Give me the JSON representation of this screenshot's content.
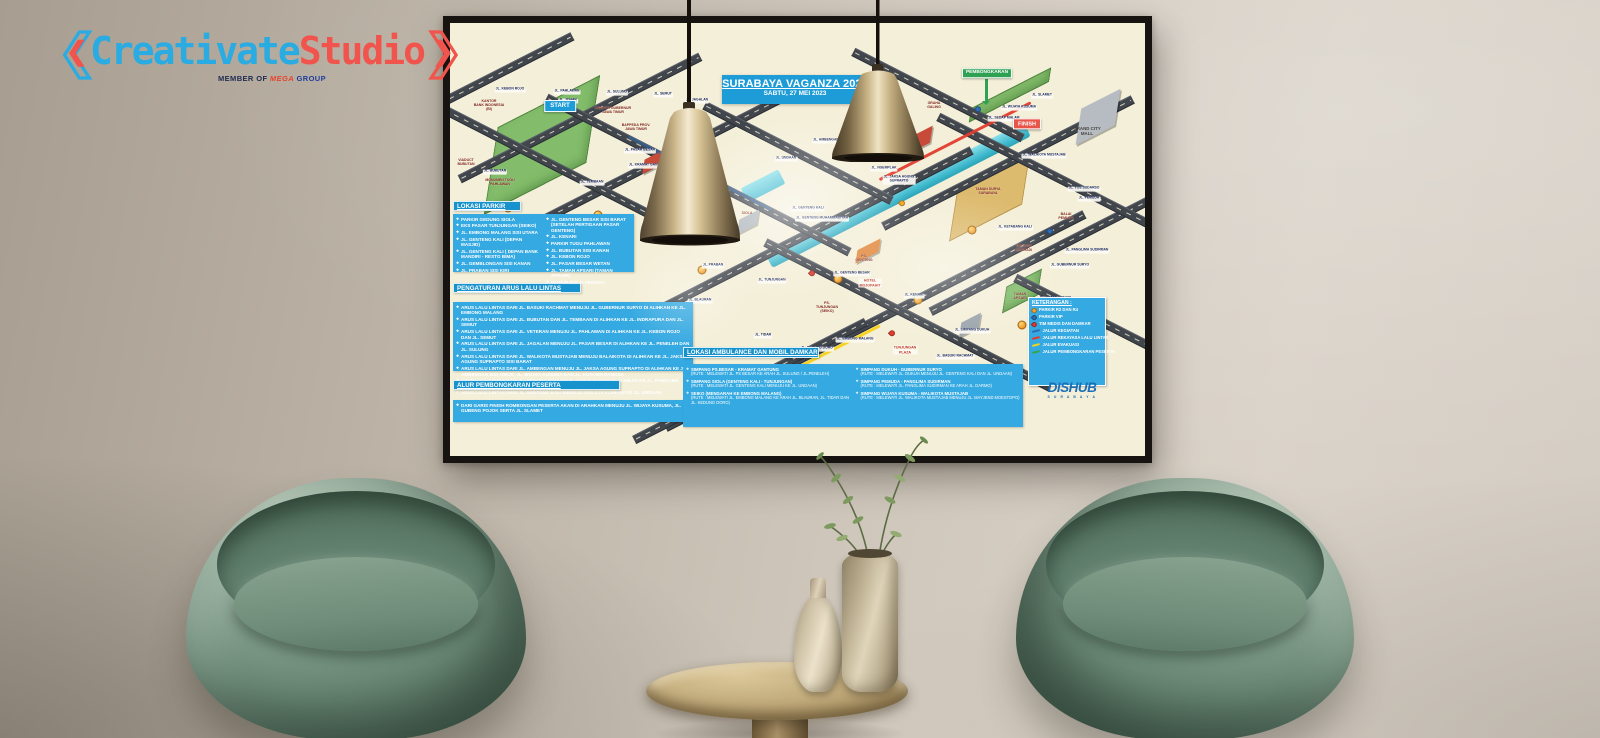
{
  "watermark": {
    "bracket_left": "❮",
    "name_primary": "Creativate",
    "name_secondary": "Studio",
    "bracket_right": "❯",
    "tagline_prefix": "MEMBER OF",
    "tagline_brand": "MEGA",
    "tagline_suffix": "GROUP"
  },
  "colors": {
    "banner_blue": "#1e9cd7",
    "legend_blue": "#35a9e1",
    "start_blue": "#1e9cd7",
    "finish_red": "#e8544a",
    "pembongkaran_green": "#2fa153",
    "brand_blue": "#2aabe2",
    "brand_red": "#f0544c"
  },
  "poster": {
    "title": "SURABAYA VAGANZA 2023",
    "subtitle": "SABTU, 27 MEI 2023",
    "agency": {
      "name": "DISHUB",
      "city": "S U R A B A Y A"
    },
    "sections": {
      "parkir": {
        "title": "LOKASI PARKIR",
        "col1": [
          "PARKIR GEDUNG SIOLA",
          "EKS PASAR TUNJUNGAN (SEIKO)",
          "JL. EMBONG MALANG SISI UTARA",
          "JL. GENTENG KALI (DEPAN MASJID)",
          "JL. GENTENG KALI ( DEPAN BANK MANDIRI - RESTO BIMA)",
          "JL. GEMBLONGAN SISI KANAN",
          "JL. PRABAN SISI KIRI"
        ],
        "col2": [
          "JL. GENTENG BESAR SISI BARAT (SETELAH PERTIGAAN PASAR GENTENG)",
          "JL. KENARI",
          "PARKIR TUGU PAHLAWAN",
          "JL. BUBUTAN SISI KANAN",
          "JL. KEBON ROJO",
          "JL. PASAR BESAR WETAN",
          "JL. TAMAN APSARI (TAMAN APSARI)",
          "PARKIR BALAI PEMUDA"
        ]
      },
      "arus": {
        "title": "PENGATURAN ARUS LALU LINTAS",
        "items": [
          "ARUS LALU LINTAS DARI JL. BASUKI RACHMAT MENUJU JL. GUBERNUR SURYO DI ALIHKAN KE JL. EMBONG MALANG",
          "ARUS LALU LINTAS DARI JL. BUBUTAN DAN JL. TEMBAAN DI ALIHKAN KE JL. INDRAPURA DAN JL. SEMUT",
          "ARUS LALU LINTAS DARI JL. VETERAN MENUJU JL. PAHLAWAN DI ALIHKAN KE JL. KEBON ROJO DAN JL. SEMUT",
          "ARUS LALU LINTAS DARI JL. JAGALAN MENUJU JL. PASAR BESAR DI ALIHKAN KE JL. PENELEH DAN JL. SULUNG",
          "ARUS LALU LINTAS DARI JL. WALIKOTA MUSTAJAB MENUJU BALAIKOTA DI ALIHKAN KE JL. JAKSA AGUNG SUPRAPTO SISI BARAT",
          "ARUS LALU LINTAS DARI JL. AMBENGAN MENUJU JL. JAKSA AGUNG SUPRAPTO DI ALIHKAN KE JL. AMBENGAN SISI TIMUR, JL. WIJAYA KUSUMA DAN JL. KUSUMA BANGSA",
          "ARUS LALU LINTAS DARI JL. PEMUDA MENUJU JL. YOS SUDARSO DI ALIHKAN KE JL. PANGLIMA SUDIRMAN",
          "ARUS LALU LINTAS DARI JL. GENTENG KALI MENUJU SIOLA DI ALIHKAN KE JL. UNDAAN"
        ]
      },
      "alur": {
        "title": "ALUR PEMBONGKARAN PESERTA",
        "items": [
          "DARI GARIS FINISH ROMBONGAN PESERTA AKAN DI ARAHKAN MENUJU JL. WIJAYA KUSUMA, JL. GUBENG POJOK SERTA JL. SLAMET"
        ]
      },
      "ambulance": {
        "title": "LOKASI AMBULANCE DAN MOBIL DAMKAR",
        "col1": [
          {
            "name": "SIMPANG PS.BESAR - KRAMAT GANTUNG",
            "route": "(RUTE : MELEWATI JL. PS BESAR KE ARAH JL. SULUNG / JL.PENELEH)"
          },
          {
            "name": "SIMPANG SIOLA (GENTENG KALI - TUNJUNGAN)",
            "route": "(RUTE : MELEWATI JL. GENTENG KALI MENUJU KE JL. UNDAAN)"
          },
          {
            "name": "SEIKO (MENGARAH KE EMBONG MALANG)",
            "route": "(RUTE : MELEWATI JL. EMBONG MALANG KE ARAH JL. BLAURAN, JL. TIDAR DAN JL. KEDUNG DORO)"
          }
        ],
        "col2": [
          {
            "name": "SIMPANG DUKUH - GUBERNUR SURYO",
            "route": "(RUTE : MELEWATI JL. DUKUH MENUJU JL. GENTENG KALI DAN JL. UNDAAN)"
          },
          {
            "name": "SIMPANG PEMUDA - PANGLIMA SUDIRMAN",
            "route": "(RUTE : MELEWATI JL. PANGLIMA SUDIRMAN KE ARAH JL. DARMO)"
          },
          {
            "name": "SIMPANG WIJAYA KUSUMA - WALIKOTA MUSTAJAB",
            "route": "(RUTE : MELEWATI JL. WALIKOTA MUSTAJAB MENUJU JL. MAYJEND MOESTOPO)"
          }
        ]
      },
      "keterangan": {
        "title": "KETERANGAN :",
        "items": [
          {
            "type": "pin",
            "color": "#f5a623",
            "label": "PARKIR R2 DAN R4"
          },
          {
            "type": "pin",
            "color": "#2f6db5",
            "label": "PARKIR VIP"
          },
          {
            "type": "pin",
            "color": "#e23b2e",
            "label": "TIM MEDIS DAN DAMKAR"
          },
          {
            "type": "line",
            "color": "#2f6db5",
            "label": "JALUR KEGIATAN"
          },
          {
            "type": "line",
            "color": "#e23b2e",
            "label": "JALUR REKAYASA LALU LINTAS"
          },
          {
            "type": "line",
            "color": "#f4d21b",
            "label": "JALUR EVAKUASI"
          },
          {
            "type": "line",
            "color": "#37a44f",
            "label": "JALUR PEMBONGKARAN PESERTA"
          }
        ]
      }
    },
    "map_labels": [
      {
        "text": "JL. KEBON ROJO",
        "x": 60,
        "y": 67,
        "type": "street"
      },
      {
        "text": "JL. PAHLAWAN",
        "x": 117,
        "y": 69,
        "type": "street"
      },
      {
        "text": "JL. JOHAR",
        "x": 118,
        "y": 78,
        "type": "street"
      },
      {
        "text": "KANTOR\nBANK INDONESIA\n(BI)",
        "x": 39,
        "y": 82,
        "type": "landmark"
      },
      {
        "text": "START",
        "x": 110,
        "y": 83,
        "type": "start"
      },
      {
        "text": "KANTOR GUBERNUR\nJAWA TIMUR",
        "x": 163,
        "y": 87,
        "type": "landmark"
      },
      {
        "text": "JL. SULUNG",
        "x": 167,
        "y": 70,
        "type": "street"
      },
      {
        "text": "BAPPEDA PROV.\nJAWA TIMUR",
        "x": 186,
        "y": 104,
        "type": "landmark"
      },
      {
        "text": "JL. SEMUT",
        "x": 213,
        "y": 72,
        "type": "street"
      },
      {
        "text": "JL. JAGALAN",
        "x": 247,
        "y": 78,
        "type": "street"
      },
      {
        "text": "VIADUCT\nBUBUTAN",
        "x": 16,
        "y": 139,
        "type": "landmark"
      },
      {
        "text": "JL. BUBUTAN",
        "x": 45,
        "y": 149,
        "type": "street"
      },
      {
        "text": "MONUMEN TUGU\nPAHLAWAN",
        "x": 50,
        "y": 159,
        "type": "landmark"
      },
      {
        "text": "JL. TEMBAAN",
        "x": 142,
        "y": 160,
        "type": "street"
      },
      {
        "text": "JL. PASAR BESAR",
        "x": 190,
        "y": 128,
        "type": "street"
      },
      {
        "text": "JL. KRAMAT GANTUNG",
        "x": 198,
        "y": 143,
        "type": "street"
      },
      {
        "text": "JL. PRABAN",
        "x": 263,
        "y": 243,
        "type": "street"
      },
      {
        "text": "JL. TUNJUNGAN",
        "x": 322,
        "y": 258,
        "type": "street"
      },
      {
        "text": "JL. BLAURAN",
        "x": 250,
        "y": 278,
        "type": "street"
      },
      {
        "text": "JL. TIDAR",
        "x": 313,
        "y": 313,
        "type": "street"
      },
      {
        "text": "JL. KEDUNG DORO",
        "x": 367,
        "y": 326,
        "type": "street"
      },
      {
        "text": "JL. EMBONG MALANG",
        "x": 405,
        "y": 317,
        "type": "street"
      },
      {
        "text": "PS.\nTUNJUNGAN\n(SEIKO)",
        "x": 377,
        "y": 284,
        "type": "landmark"
      },
      {
        "text": "TUNJUNGAN\nPLAZA",
        "x": 455,
        "y": 327,
        "type": "poi"
      },
      {
        "text": "JL. BASUKI RACHMAT",
        "x": 505,
        "y": 334,
        "type": "street"
      },
      {
        "text": "JL. SIMPANG DUKUH",
        "x": 522,
        "y": 308,
        "type": "street"
      },
      {
        "text": "JL. KENARI",
        "x": 464,
        "y": 273,
        "type": "street"
      },
      {
        "text": "HOTEL\nMOJOPAHIT",
        "x": 420,
        "y": 260,
        "type": "poi"
      },
      {
        "text": "PS.\nGENTENG",
        "x": 414,
        "y": 235,
        "type": "landmark"
      },
      {
        "text": "JL. GENTENG BESAR",
        "x": 402,
        "y": 251,
        "type": "street"
      },
      {
        "text": "JL. GENTENG KALI",
        "x": 358,
        "y": 186,
        "type": "street"
      },
      {
        "text": "JL. GENTENG MUHAMMADIYAH",
        "x": 372,
        "y": 196,
        "type": "street"
      },
      {
        "text": "SIOLA",
        "x": 297,
        "y": 190,
        "type": "landmark"
      },
      {
        "text": "JL. UNDAAN",
        "x": 336,
        "y": 136,
        "type": "street"
      },
      {
        "text": "JL. AMBENGAN",
        "x": 376,
        "y": 118,
        "type": "street"
      },
      {
        "text": "JL. NGEMPLAK",
        "x": 434,
        "y": 146,
        "type": "street"
      },
      {
        "text": "JL. JAKSA AGUNG\nSUPRAPTO",
        "x": 449,
        "y": 157,
        "type": "street"
      },
      {
        "text": "JL. SEDAP MALAM",
        "x": 554,
        "y": 96,
        "type": "street"
      },
      {
        "text": "GRAHA\nGALING",
        "x": 484,
        "y": 82,
        "type": "landmark"
      },
      {
        "text": "PEMBONGKARAN",
        "x": 537,
        "y": 50,
        "type": "demob"
      },
      {
        "text": "JL. SLAMET",
        "x": 592,
        "y": 73,
        "type": "street"
      },
      {
        "text": "JL. WIJAYA KUSUMA",
        "x": 569,
        "y": 85,
        "type": "street"
      },
      {
        "text": "FINISH",
        "x": 577,
        "y": 101,
        "type": "finish"
      },
      {
        "text": "GRAND CITY\nMALL",
        "x": 637,
        "y": 108,
        "type": "dark"
      },
      {
        "text": "JL. WALIKOTA MUSTAJAB",
        "x": 594,
        "y": 133,
        "type": "street"
      },
      {
        "text": "JL. YOS SUDARSO",
        "x": 634,
        "y": 166,
        "type": "street"
      },
      {
        "text": "JL. PEMUDA",
        "x": 639,
        "y": 176,
        "type": "street"
      },
      {
        "text": "TAMAN SURYA\nSURABAYA",
        "x": 538,
        "y": 168,
        "type": "landmark"
      },
      {
        "text": "BALAI\nPEMUDA",
        "x": 616,
        "y": 193,
        "type": "landmark"
      },
      {
        "text": "JL. KETABANG KALI",
        "x": 565,
        "y": 205,
        "type": "street"
      },
      {
        "text": "GEDUNG\nGRAHADI",
        "x": 574,
        "y": 225,
        "type": "landmark"
      },
      {
        "text": "JL. PANGLIMA SUDIRMAN",
        "x": 637,
        "y": 228,
        "type": "street"
      },
      {
        "text": "JL. GUBERNUR SURYO",
        "x": 620,
        "y": 243,
        "type": "street"
      },
      {
        "text": "TAMAN\nAPSARI",
        "x": 570,
        "y": 273,
        "type": "landmark"
      },
      {
        "text": "JL. TAMAN APSARI",
        "x": 605,
        "y": 276,
        "type": "street"
      }
    ]
  }
}
